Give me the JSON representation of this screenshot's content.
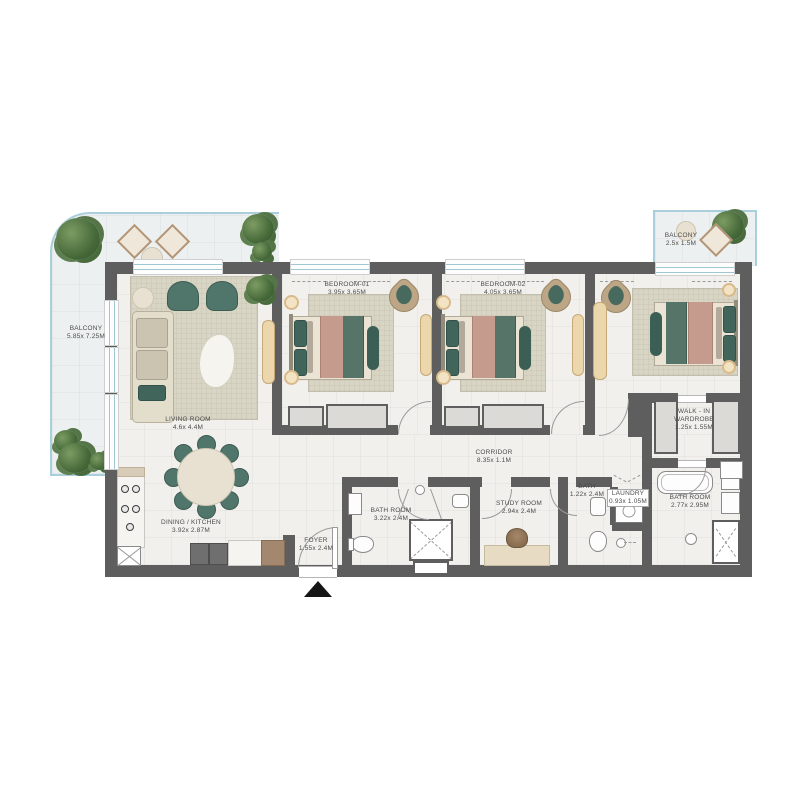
{
  "plan_title": "3-bedroom apartment floor plan",
  "colors": {
    "wall": "#5e5e5e",
    "balcony_border": "#aacfdc",
    "teal_furniture": "#50756a",
    "rose_blanket": "#c59b8d",
    "floor": "#f1f0ed",
    "wood": "#ecd6ab",
    "entrance_arrow": "#151515"
  },
  "rooms": {
    "balcony_left": {
      "name": "BALCONY",
      "dims": "5.85x 7.25M"
    },
    "living_room": {
      "name": "LIVING ROOM",
      "dims": "4.6x 4.4M"
    },
    "dining_kitchen": {
      "name": "DINING / KITCHEN",
      "dims": "3.92x 2.87M"
    },
    "foyer": {
      "name": "FOYER",
      "dims": "1.55x 2.4M"
    },
    "bedroom_01": {
      "name": "BEDROOM-01",
      "dims": "3.95x 3.65M"
    },
    "bedroom_02": {
      "name": "BEDROOM-02",
      "dims": "4.05x 3.65M"
    },
    "corridor": {
      "name": "CORRIDOR",
      "dims": "8.35x 1.1M"
    },
    "bathroom_main": {
      "name": "BATH ROOM",
      "dims": "3.22x 2.4M"
    },
    "study_room": {
      "name": "STUDY ROOM",
      "dims": "2.94x 2.4M"
    },
    "bath": {
      "name": "BATH",
      "dims": "1.22x 2.4M"
    },
    "laundry": {
      "name": "LAUNDRY",
      "dims": "0.93x 1.05M"
    },
    "walk_in_wardrobe": {
      "line1": "WALK - IN",
      "line2": "WARDROBE",
      "dims": "1.25x 1.55M"
    },
    "bathroom_master": {
      "name": "BATH ROOM",
      "dims": "2.77x 2.95M"
    },
    "balcony_right": {
      "name": "BALCONY",
      "dims": "2.5x 1.5M"
    }
  }
}
